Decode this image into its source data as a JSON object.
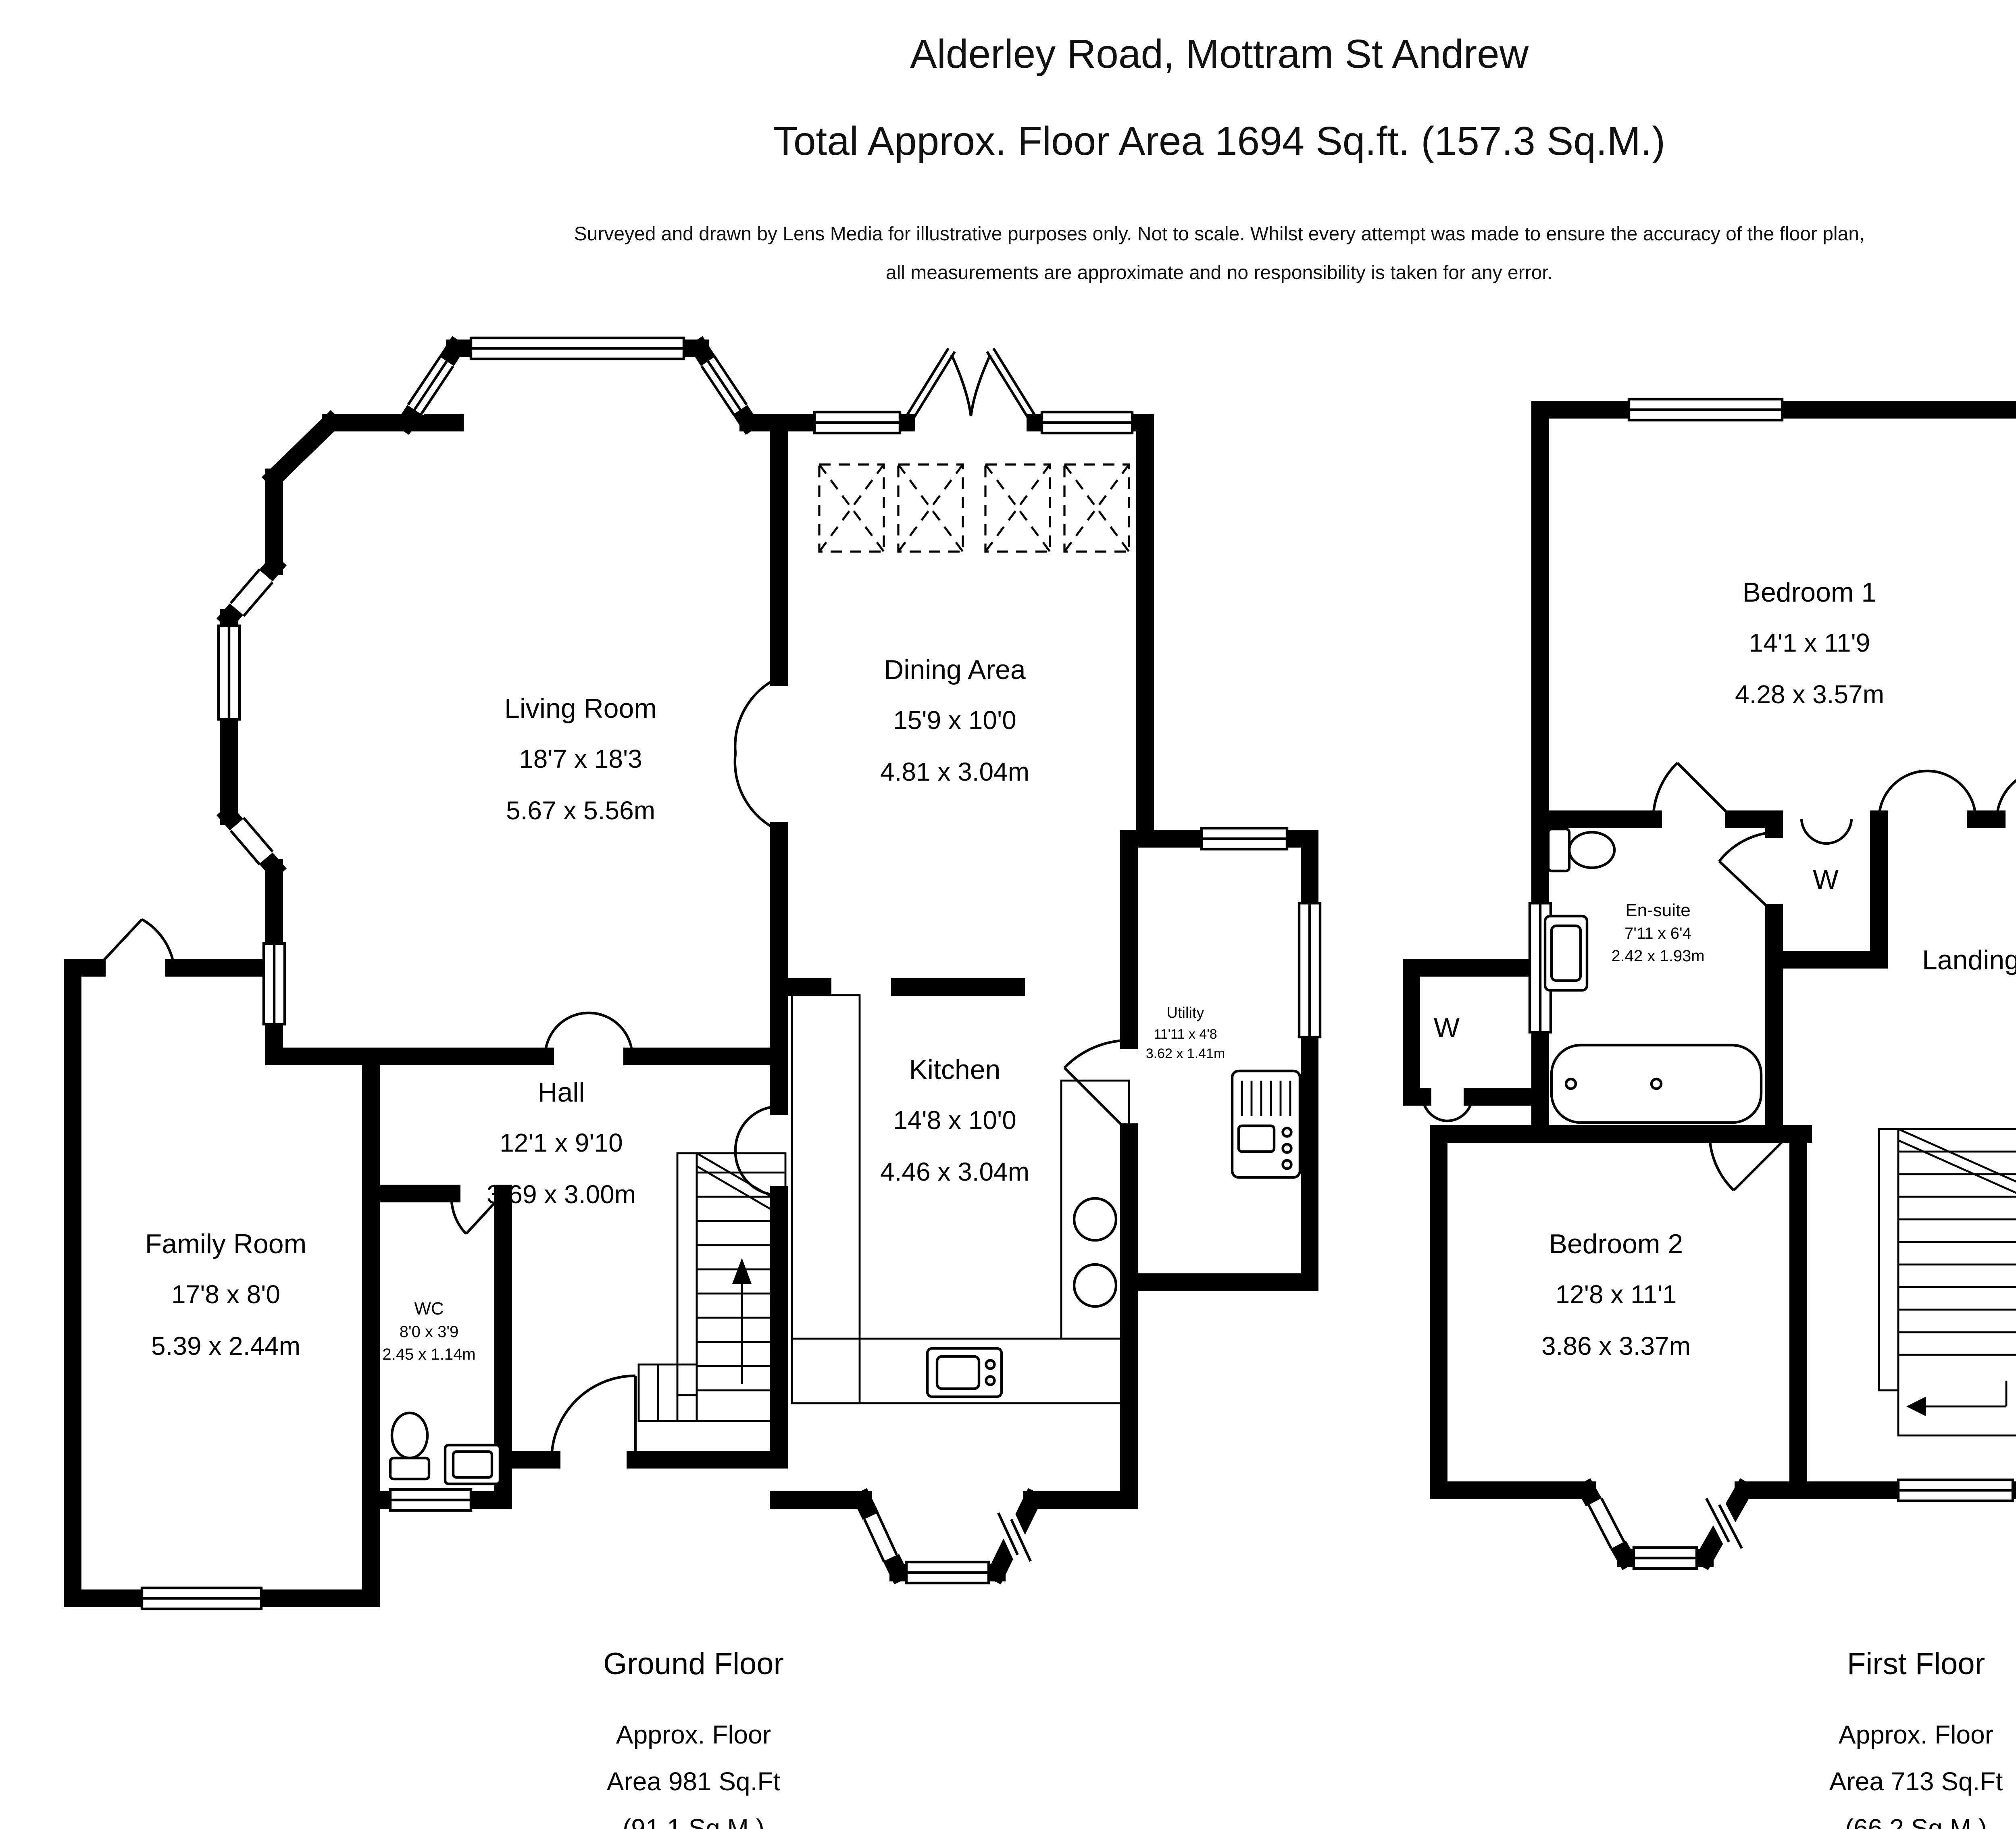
{
  "header": {
    "title": "Alderley Road, Mottram St Andrew",
    "subtitle": "Total Approx. Floor Area 1694 Sq.ft. (157.3 Sq.M.)",
    "disclaimer_line1": "Surveyed and drawn by Lens Media for illustrative purposes only. Not to scale. Whilst every attempt was made to ensure the accuracy of the floor plan,",
    "disclaimer_line2": "all measurements are approximate and no responsibility is taken for any error."
  },
  "ground_floor": {
    "caption": "Ground Floor",
    "area_line1": "Approx. Floor",
    "area_line2": "Area 981 Sq.Ft",
    "area_line3": "(91.1 Sq.M.)",
    "rooms": {
      "living_room": {
        "name": "Living Room",
        "imperial": "18'7 x 18'3",
        "metric": "5.67 x 5.56m"
      },
      "dining_area": {
        "name": "Dining Area",
        "imperial": "15'9 x 10'0",
        "metric": "4.81 x 3.04m"
      },
      "hall": {
        "name": "Hall",
        "imperial": "12'1 x 9'10",
        "metric": "3.69 x 3.00m"
      },
      "kitchen": {
        "name": "Kitchen",
        "imperial": "14'8 x 10'0",
        "metric": "4.46 x 3.04m"
      },
      "utility": {
        "name": "Utility",
        "imperial": "11'11 x 4'8",
        "metric": "3.62 x 1.41m"
      },
      "family_room": {
        "name": "Family Room",
        "imperial": "17'8 x 8'0",
        "metric": "5.39 x 2.44m"
      },
      "wc": {
        "name": "WC",
        "imperial": "8'0 x 3'9",
        "metric": "2.45 x 1.14m"
      }
    }
  },
  "first_floor": {
    "caption": "First Floor",
    "area_line1": "Approx. Floor",
    "area_line2": "Area 713 Sq.Ft",
    "area_line3": "(66.2 Sq.M.)",
    "wardrobe_label": "W",
    "rooms": {
      "bedroom1": {
        "name": "Bedroom 1",
        "imperial": "14'1 x 11'9",
        "metric": "4.28 x 3.57m"
      },
      "roof_terrace": {
        "name": "Roof Terrace",
        "imperial": "10'4 x 6'11",
        "metric": "3.15 x 2.11m"
      },
      "en_suite": {
        "name": "En-suite",
        "imperial": "7'11 x 6'4",
        "metric": "2.42 x 1.93m"
      },
      "landing": {
        "name": "Landing"
      },
      "bathroom": {
        "name": "Bathroom",
        "imperial": "6'8 x 6'4",
        "metric": "2.02 x 1.92m"
      },
      "bedroom2": {
        "name": "Bedroom 2",
        "imperial": "12'8 x 11'1",
        "metric": "3.86 x 3.37m"
      },
      "bedroom3": {
        "name": "Bedroom 3",
        "imperial": "12'2 x 10'4",
        "metric": "3.70 x 3.16m"
      }
    }
  },
  "compass": {
    "north": "N",
    "south": "S",
    "east": "E",
    "west": "W"
  }
}
